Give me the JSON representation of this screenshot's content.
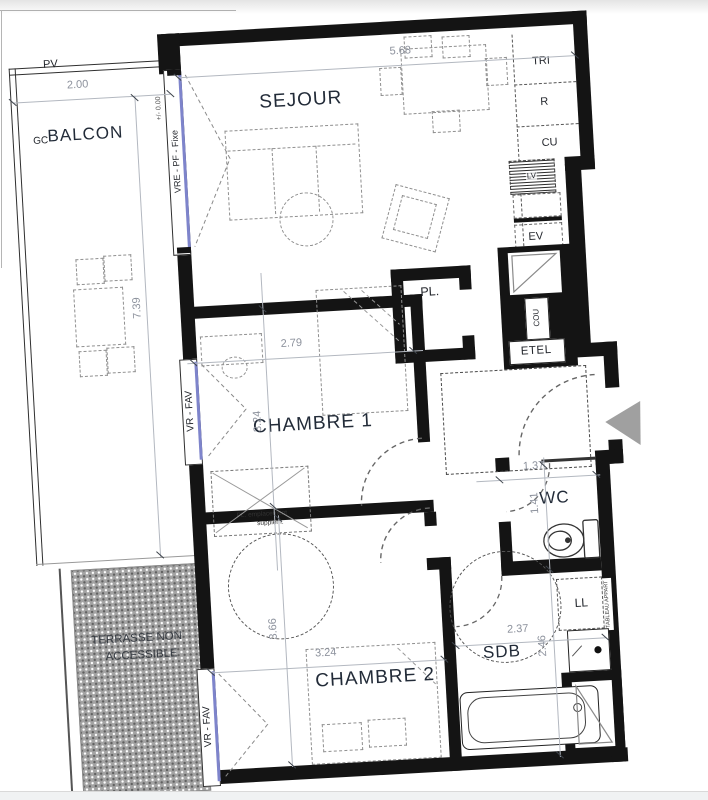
{
  "rooms": {
    "balcon": {
      "label": "BALCON"
    },
    "sejour": {
      "label": "SEJOUR"
    },
    "chambre1": {
      "label": "CHAMBRE 1"
    },
    "chambre2": {
      "label": "CHAMBRE 2"
    },
    "wc": {
      "label": "WC"
    },
    "sdb": {
      "label": "SDB"
    },
    "terrasse": {
      "line1": "TERRASSE NON",
      "line2": "ACCESSIBLE"
    }
  },
  "dims": {
    "balcon_w": "2.00",
    "balcon_h": "7.39",
    "sejour_w": "5.68",
    "chambre1_w": "2.79",
    "chambre1_h": "3.24",
    "chambre2_w": "3.24",
    "chambre2_h": "3.66",
    "wc_w": "1.37",
    "wc_h": "1.41",
    "sdb_w": "2.37",
    "sdb_h": "2.46"
  },
  "labels": {
    "pv": "PV",
    "gc": "GC",
    "tri": "TRI",
    "r": "R",
    "cu": "CU",
    "lv": "LV",
    "ev": "EV",
    "pl": "PL.",
    "pl_extra_line1": "PL. emplacement",
    "pl_extra_line2": "supplém.",
    "cou": "COU",
    "etel": "ETEL",
    "ll": "LL",
    "tableau": "TABLEAU APPART",
    "window_fixed": "VRE - PF - Fixe",
    "level": "+/- 0.00",
    "window_vr_1": "VR - FAV",
    "window_vr_2": "VR - FAV"
  },
  "colors": {
    "wall": "#141414",
    "glazing": "#7e84cb",
    "dimension": "#8d929d",
    "room_label": "#222b38",
    "furniture": "#8f8f8f",
    "terrace": "#a3a3a3",
    "entry_arrow": "#a0a0a0"
  }
}
